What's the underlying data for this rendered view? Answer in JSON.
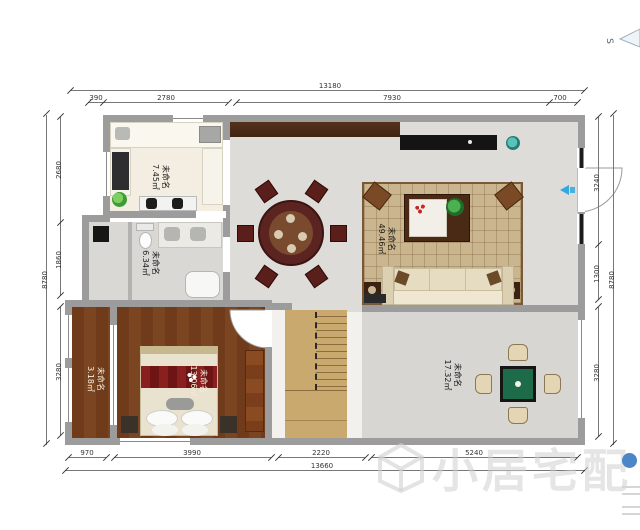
{
  "compass": {
    "label": "S"
  },
  "watermark": {
    "text": "小居宅配"
  },
  "rooms": [
    {
      "id": "kitchen",
      "name": "未命名",
      "area": "7.45㎡"
    },
    {
      "id": "bathroom",
      "name": "未命名",
      "area": "6.34㎡"
    },
    {
      "id": "living-room",
      "name": "未命名",
      "area": "49.46㎡"
    },
    {
      "id": "bedroom",
      "name": "未命名",
      "area": "13.06㎡"
    },
    {
      "id": "balcony",
      "name": "未命名",
      "area": "3.18㎡"
    },
    {
      "id": "mahjong-room",
      "name": "未命名",
      "area": "17.32㎡"
    }
  ],
  "dimensions": {
    "top": {
      "overall": "13180",
      "segments": [
        "390",
        "2780",
        "7930",
        "700"
      ]
    },
    "bottom": {
      "overall": "13660",
      "segments": [
        "970",
        "3990",
        "2220",
        "5240"
      ]
    },
    "left": {
      "overall": "8780",
      "segments": [
        "2680",
        "1860",
        "3280"
      ]
    },
    "right": {
      "overall": "8780",
      "segments": [
        "3240",
        "1300",
        "3280"
      ]
    }
  },
  "colors": {
    "wall": "#9c9c9c",
    "wood_floor": "#6f3b1b",
    "stairs": "#c9a96e",
    "mahjong_table": "#1e6b4a",
    "accent_blue": "#31a8e0"
  }
}
